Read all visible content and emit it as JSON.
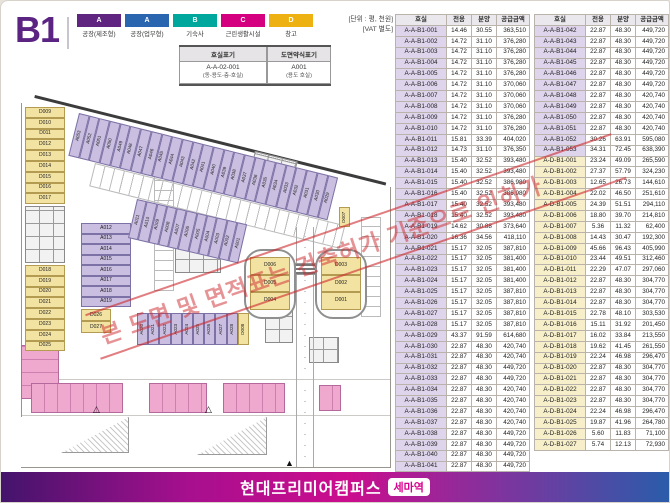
{
  "page": {
    "floor": "B1",
    "unit_note_1": "[단위 : 평, 천원]",
    "unit_note_2": "[VAT 별도]"
  },
  "legend": {
    "items": [
      {
        "code": "A",
        "label": "공장(제조형)",
        "color": "#5f2580"
      },
      {
        "code": "A",
        "label": "공장(업무형)",
        "color": "#2a66af"
      },
      {
        "code": "B",
        "label": "기숙사",
        "color": "#00a79d"
      },
      {
        "code": "C",
        "label": "근린생활시설",
        "color": "#d4007f"
      },
      {
        "code": "D",
        "label": "창고",
        "color": "#edb211"
      }
    ]
  },
  "notation": {
    "col1_header": "호실표기",
    "col2_header": "도면약식표기",
    "col1_value": "A-A-02-001",
    "col1_sub": "(동-용도-층-호실)",
    "col2_value": "A001",
    "col2_sub": "(용도 호실)"
  },
  "watermark": "본 도면 및 면적표는 건축허가 기준으로 인허가",
  "plan": {
    "left_top_d": [
      "D009",
      "D010",
      "D011",
      "D012",
      "D013",
      "D014",
      "D015",
      "D016",
      "D017"
    ],
    "left_bottom_d": [
      "D018",
      "D019",
      "D020",
      "D021",
      "D022",
      "D023",
      "D024",
      "D025"
    ],
    "top_strip_a": [
      "A053",
      "A052",
      "A051",
      "A050",
      "A049",
      "A048",
      "A047",
      "A046",
      "A045",
      "A044",
      "A043",
      "A042",
      "A041",
      "A040",
      "A039",
      "A038",
      "A037",
      "A036",
      "A035",
      "A034",
      "A033",
      "A032",
      "A031",
      "A030",
      "A029"
    ],
    "mid_strip_a": [
      "A011",
      "A010",
      "A009",
      "A008",
      "A007",
      "A006",
      "A005",
      "A004",
      "A003",
      "A002",
      "A001"
    ],
    "center_col_a": [
      "A012",
      "A013",
      "A014",
      "A015",
      "A016",
      "A017",
      "A018",
      "A019"
    ],
    "small_d": [
      "D026",
      "D027"
    ],
    "bottom_strip_a": [
      "A020",
      "A021",
      "A022",
      "A023",
      "A024",
      "A025",
      "A026",
      "A027",
      "A028"
    ],
    "bottom_strip_d": "D008",
    "small_d_right": "D007",
    "left_oval_d": [
      "D006",
      "D005",
      "D004"
    ],
    "right_oval_d": [
      "D003",
      "D002",
      "D001"
    ],
    "courtyard_label": "COURTYARD"
  },
  "tables": {
    "headers": [
      "호실",
      "전용",
      "분양",
      "공급금액"
    ],
    "left_rows": [
      [
        "A-A-B1-001",
        "14.46",
        "30.55",
        "363,510"
      ],
      [
        "A-A-B1-002",
        "14.72",
        "31.10",
        "376,280"
      ],
      [
        "A-A-B1-003",
        "14.72",
        "31.10",
        "376,280"
      ],
      [
        "A-A-B1-004",
        "14.72",
        "31.10",
        "376,280"
      ],
      [
        "A-A-B1-005",
        "14.72",
        "31.10",
        "376,280"
      ],
      [
        "A-A-B1-006",
        "14.72",
        "31.10",
        "370,060"
      ],
      [
        "A-A-B1-007",
        "14.72",
        "31.10",
        "370,060"
      ],
      [
        "A-A-B1-008",
        "14.72",
        "31.10",
        "370,060"
      ],
      [
        "A-A-B1-009",
        "14.72",
        "31.10",
        "376,280"
      ],
      [
        "A-A-B1-010",
        "14.72",
        "31.10",
        "376,280"
      ],
      [
        "A-A-B1-011",
        "15.81",
        "33.39",
        "404,020"
      ],
      [
        "A-A-B1-012",
        "14.73",
        "31.10",
        "376,350"
      ],
      [
        "A-A-B1-013",
        "15.40",
        "32.52",
        "393,480"
      ],
      [
        "A-A-B1-014",
        "15.40",
        "32.52",
        "393,480"
      ],
      [
        "A-A-B1-015",
        "15.40",
        "32.52",
        "386,980"
      ],
      [
        "A-A-B1-016",
        "15.40",
        "32.52",
        "386,980"
      ],
      [
        "A-A-B1-017",
        "15.40",
        "32.52",
        "393,480"
      ],
      [
        "A-A-B1-018",
        "15.40",
        "32.52",
        "393,480"
      ],
      [
        "A-A-B1-019",
        "14.62",
        "30.88",
        "373,640"
      ],
      [
        "A-A-B1-020",
        "16.36",
        "34.56",
        "418,110"
      ],
      [
        "A-A-B1-021",
        "15.17",
        "32.05",
        "387,810"
      ],
      [
        "A-A-B1-022",
        "15.17",
        "32.05",
        "381,400"
      ],
      [
        "A-A-B1-023",
        "15.17",
        "32.05",
        "381,400"
      ],
      [
        "A-A-B1-024",
        "15.17",
        "32.05",
        "381,400"
      ],
      [
        "A-A-B1-025",
        "15.17",
        "32.05",
        "387,810"
      ],
      [
        "A-A-B1-026",
        "15.17",
        "32.05",
        "387,810"
      ],
      [
        "A-A-B1-027",
        "15.17",
        "32.05",
        "387,810"
      ],
      [
        "A-A-B1-028",
        "15.17",
        "32.05",
        "387,810"
      ],
      [
        "A-A-B1-029",
        "43.37",
        "91.59",
        "614,680"
      ],
      [
        "A-A-B1-030",
        "22.87",
        "48.30",
        "420,740"
      ],
      [
        "A-A-B1-031",
        "22.87",
        "48.30",
        "420,740"
      ],
      [
        "A-A-B1-032",
        "22.87",
        "48.30",
        "449,720"
      ],
      [
        "A-A-B1-033",
        "22.87",
        "48.30",
        "449,720"
      ],
      [
        "A-A-B1-034",
        "22.87",
        "48.30",
        "420,740"
      ],
      [
        "A-A-B1-035",
        "22.87",
        "48.30",
        "420,740"
      ],
      [
        "A-A-B1-036",
        "22.87",
        "48.30",
        "420,740"
      ],
      [
        "A-A-B1-037",
        "22.87",
        "48.30",
        "420,740"
      ],
      [
        "A-A-B1-038",
        "22.87",
        "48.30",
        "449,720"
      ],
      [
        "A-A-B1-039",
        "22.87",
        "48.30",
        "449,720"
      ],
      [
        "A-A-B1-040",
        "22.87",
        "48.30",
        "449,720"
      ],
      [
        "A-A-B1-041",
        "22.87",
        "48.30",
        "449,720"
      ]
    ],
    "right_rows": [
      [
        "A-A-B1-042",
        "22.87",
        "48.30",
        "449,720"
      ],
      [
        "A-A-B1-043",
        "22.87",
        "48.30",
        "449,720"
      ],
      [
        "A-A-B1-044",
        "22.87",
        "48.30",
        "449,720"
      ],
      [
        "A-A-B1-045",
        "22.87",
        "48.30",
        "449,720"
      ],
      [
        "A-A-B1-046",
        "22.87",
        "48.30",
        "449,720"
      ],
      [
        "A-A-B1-047",
        "22.87",
        "48.30",
        "449,720"
      ],
      [
        "A-A-B1-048",
        "22.87",
        "48.30",
        "420,740"
      ],
      [
        "A-A-B1-049",
        "22.87",
        "48.30",
        "420,740"
      ],
      [
        "A-A-B1-050",
        "22.87",
        "48.30",
        "420,740"
      ],
      [
        "A-A-B1-051",
        "22.87",
        "48.30",
        "420,740"
      ],
      [
        "A-A-B1-052",
        "30.26",
        "63.91",
        "595,080"
      ],
      [
        "A-A-B1-053",
        "34.31",
        "72.45",
        "638,390"
      ],
      [
        "A-D-B1-001",
        "23.24",
        "49.09",
        "265,590"
      ],
      [
        "A-D-B1-002",
        "27.37",
        "57.79",
        "324,230"
      ],
      [
        "A-D-B1-003",
        "12.65",
        "26.73",
        "144,610"
      ],
      [
        "A-D-B1-004",
        "22.02",
        "46.50",
        "251,610"
      ],
      [
        "A-D-B1-005",
        "24.39",
        "51.51",
        "294,110"
      ],
      [
        "A-D-B1-006",
        "18.80",
        "39.70",
        "214,810"
      ],
      [
        "A-D-B1-007",
        "5.36",
        "11.32",
        "62,400"
      ],
      [
        "A-D-B1-008",
        "14.43",
        "30.47",
        "192,300"
      ],
      [
        "A-D-B1-009",
        "45.66",
        "96.43",
        "405,990"
      ],
      [
        "A-D-B1-010",
        "23.44",
        "49.51",
        "312,460"
      ],
      [
        "A-D-B1-011",
        "22.29",
        "47.07",
        "297,060"
      ],
      [
        "A-D-B1-012",
        "22.87",
        "48.30",
        "304,770"
      ],
      [
        "A-D-B1-013",
        "22.87",
        "48.30",
        "304,770"
      ],
      [
        "A-D-B1-014",
        "22.87",
        "48.30",
        "304,770"
      ],
      [
        "A-D-B1-015",
        "22.78",
        "48.10",
        "303,530"
      ],
      [
        "A-D-B1-016",
        "15.11",
        "31.92",
        "201,450"
      ],
      [
        "A-D-B1-017",
        "16.02",
        "33.84",
        "213,550"
      ],
      [
        "A-D-B1-018",
        "19.62",
        "41.45",
        "261,550"
      ],
      [
        "A-D-B1-019",
        "22.24",
        "46.98",
        "296,470"
      ],
      [
        "A-D-B1-020",
        "22.87",
        "48.30",
        "304,770"
      ],
      [
        "A-D-B1-021",
        "22.87",
        "48.30",
        "304,770"
      ],
      [
        "A-D-B1-022",
        "22.87",
        "48.30",
        "304,770"
      ],
      [
        "A-D-B1-023",
        "22.87",
        "48.30",
        "304,770"
      ],
      [
        "A-D-B1-024",
        "22.24",
        "46.98",
        "296,470"
      ],
      [
        "A-D-B1-025",
        "19.87",
        "41.96",
        "264,780"
      ],
      [
        "A-D-B1-026",
        "5.60",
        "11.83",
        "71,100"
      ],
      [
        "A-D-B1-027",
        "5.74",
        "12.13",
        "72,930"
      ]
    ]
  },
  "footer": {
    "title": "현대프리미어캠퍼스",
    "badge": "세마역"
  }
}
